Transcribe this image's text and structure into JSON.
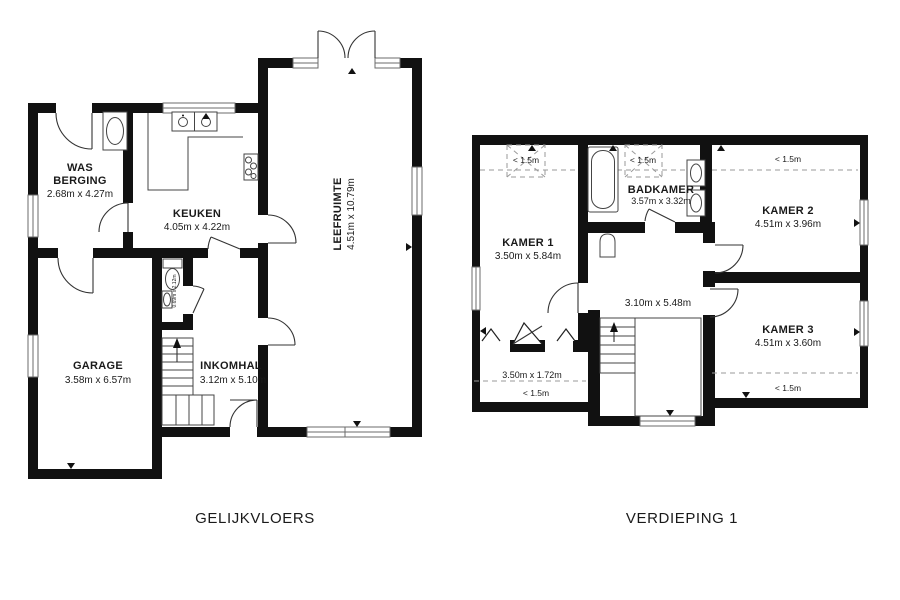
{
  "ground_floor": {
    "title": "GELIJKVLOERS",
    "rooms": {
      "was_berging": {
        "line1": "WAS",
        "line2": "BERGING",
        "dims": "2.68m x 4.27m"
      },
      "keuken": {
        "name": "KEUKEN",
        "dims": "4.05m x 4.22m"
      },
      "leefruimte": {
        "name": "LEEFRUIMTE",
        "dims": "4.51m x 10.79m"
      },
      "garage": {
        "name": "GARAGE",
        "dims": "3.58m x 6.57m"
      },
      "inkomhal": {
        "name": "INKOMHAL",
        "dims": "3.12m x 5.10m"
      },
      "wc": {
        "dims": "0.69m x 2.12m"
      }
    }
  },
  "first_floor": {
    "title": "VERDIEPING 1",
    "rooms": {
      "kamer1": {
        "name": "KAMER 1",
        "dims": "3.50m x 5.84m"
      },
      "badkamer": {
        "name": "BADKAMER",
        "dims": "3.57m x 3.32m"
      },
      "kamer2": {
        "name": "KAMER 2",
        "dims": "4.51m x 3.96m",
        "height_note": "< 1.5m"
      },
      "kamer3": {
        "name": "KAMER 3",
        "dims": "4.51m x 3.60m",
        "height_note": "< 1.5m"
      },
      "overloop": {
        "dims": "3.10m x 5.48m"
      },
      "berging": {
        "dims": "3.50m x 1.72m",
        "height_note": "< 1.5m"
      },
      "velux1": {
        "height_note": "< 1.5m"
      },
      "velux2": {
        "height_note": "< 1.5m"
      }
    }
  },
  "colors": {
    "wall": "#111111",
    "line": "#444444",
    "dashed": "#9a9a9a",
    "background": "#ffffff"
  }
}
